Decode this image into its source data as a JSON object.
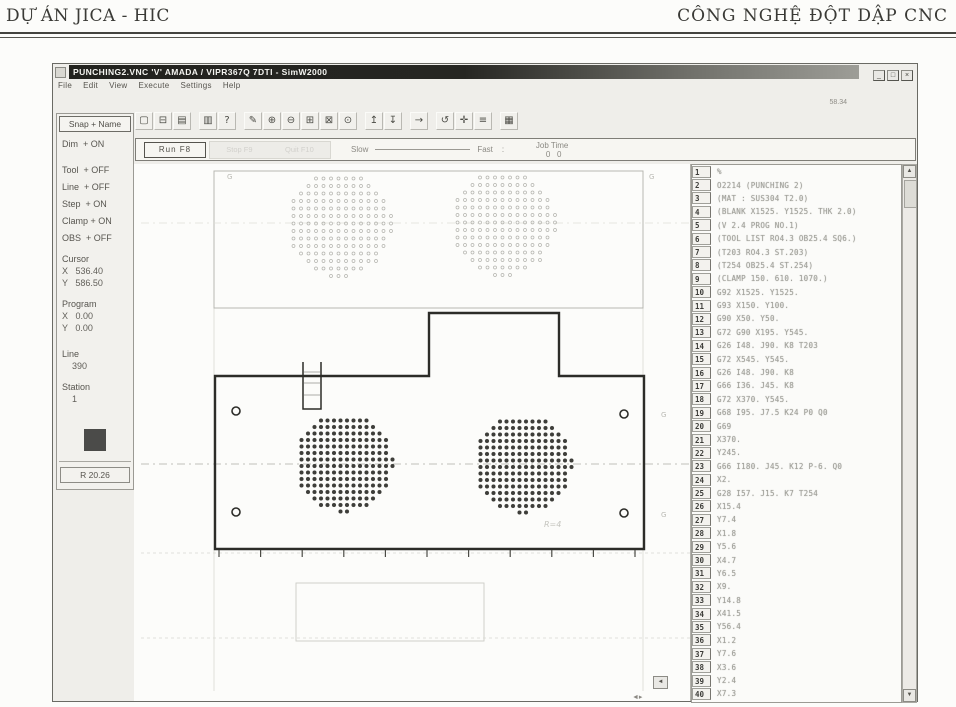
{
  "header": {
    "left": "DỰ ÁN JICA - HIC",
    "right": "CÔNG NGHỆ ĐỘT DẬP CNC"
  },
  "window": {
    "title": "PUNCHING2.VNC 'V' AMADA / VIPR367Q 7DTI - SimW2000",
    "controls": [
      {
        "name": "minimize-button",
        "glyph": "_"
      },
      {
        "name": "maximize-button",
        "glyph": "□"
      },
      {
        "name": "close-button",
        "glyph": "×"
      }
    ],
    "menu": [
      "File",
      "Edit",
      "View",
      "Execute",
      "Settings",
      "Help"
    ],
    "corner_note": "58.34"
  },
  "toolbar": {
    "groups": [
      [
        "new",
        "open",
        "save"
      ],
      [
        "print",
        "help"
      ],
      [
        "pointer",
        "zoom-in",
        "zoom-out",
        "zoom-window",
        "zoom-fit",
        "zoom-prev"
      ],
      [
        "step-up",
        "step-down"
      ],
      [
        "run-forward"
      ],
      [
        "rotate",
        "crosshair",
        "list"
      ],
      [
        "nc-editor"
      ]
    ],
    "glyphs": {
      "new": "▢",
      "open": "⊟",
      "save": "▤",
      "print": "▥",
      "help": "?",
      "pointer": "✎",
      "zoom-in": "⊕",
      "zoom-out": "⊖",
      "zoom-window": "⊞",
      "zoom-fit": "⊠",
      "zoom-prev": "⊙",
      "step-up": "↥",
      "step-down": "↧",
      "run-forward": "→",
      "rotate": "↺",
      "crosshair": "✛",
      "list": "≡",
      "nc-editor": "▦"
    }
  },
  "sidebar": {
    "snap_button": "Snap + Name",
    "items": [
      {
        "name": "toggle-dim",
        "text": "Dim  + ON",
        "cls": ""
      },
      {
        "name": "toggle-tool",
        "text": "Tool  + OFF",
        "cls": "glg"
      },
      {
        "name": "toggle-line",
        "text": "Line  + OFF",
        "cls": "gsm"
      },
      {
        "name": "toggle-step",
        "text": "Step  + ON",
        "cls": "gsm"
      },
      {
        "name": "toggle-clamp",
        "text": "Clamp + ON",
        "cls": "gsm"
      },
      {
        "name": "toggle-obs",
        "text": "OBS  + OFF",
        "cls": "gsm"
      },
      {
        "name": "cursor-label",
        "text": "Cursor",
        "cls": "gmd"
      },
      {
        "name": "cursor-x",
        "text": "X   536.40",
        "cls": "val"
      },
      {
        "name": "cursor-y",
        "text": "Y   586.50",
        "cls": "val"
      },
      {
        "name": "program-label",
        "text": "Program",
        "cls": "gmd"
      },
      {
        "name": "program-x",
        "text": "X   0.00",
        "cls": "val"
      },
      {
        "name": "program-y",
        "text": "Y   0.00",
        "cls": "val"
      },
      {
        "name": "line-label",
        "text": "Line",
        "cls": "glg"
      },
      {
        "name": "line-value",
        "text": "390",
        "cls": "val ind"
      },
      {
        "name": "station-label",
        "text": "Station",
        "cls": "gmd"
      },
      {
        "name": "station-value",
        "text": "1",
        "cls": "val ind"
      }
    ],
    "swatch_color": "#4b4b49",
    "bottom_button": "R 20.26"
  },
  "runbar": {
    "run_label": "Run F8",
    "ghost_labels": [
      "Stop F9",
      "Quit F10"
    ],
    "slow_label": "Slow",
    "fast_label": "Fast",
    "sep": ":",
    "job_label": "Job Time",
    "job_values": "0   0"
  },
  "nc_list": {
    "rows": [
      {
        "n": "1",
        "text": "%"
      },
      {
        "n": "2",
        "text": "O2214 (PUNCHING 2)"
      },
      {
        "n": "3",
        "text": "(MAT : SUS304 T2.0)"
      },
      {
        "n": "4",
        "text": "(BLANK X1525. Y1525. THK 2.0)"
      },
      {
        "n": "5",
        "text": "(V 2.4 PROG NO.1)"
      },
      {
        "n": "6",
        "text": "(TOOL LIST RO4.3 OB25.4 SQ6.)"
      },
      {
        "n": "7",
        "text": "(T203 RO4.3 ST.203)"
      },
      {
        "n": "8",
        "text": "(T254 OB25.4 ST.254)"
      },
      {
        "n": "9",
        "text": "(CLAMP 150. 610. 1070.)"
      },
      {
        "n": "10",
        "text": "G92 X1525. Y1525."
      },
      {
        "n": "11",
        "text": "G93 X150. Y100."
      },
      {
        "n": "12",
        "text": "G90 X50. Y50."
      },
      {
        "n": "13",
        "text": "G72 G90 X195. Y545."
      },
      {
        "n": "14",
        "text": "G26 I48. J90. K8 T203"
      },
      {
        "n": "15",
        "text": "G72 X545. Y545."
      },
      {
        "n": "16",
        "text": "G26 I48. J90. K8"
      },
      {
        "n": "17",
        "text": "G66 I36. J45. K8"
      },
      {
        "n": "18",
        "text": "G72 X370. Y545."
      },
      {
        "n": "19",
        "text": "G68 I95. J7.5 K24 P0 Q0"
      },
      {
        "n": "20",
        "text": "G69"
      },
      {
        "n": "21",
        "text": "X370."
      },
      {
        "n": "22",
        "text": "Y245."
      },
      {
        "n": "23",
        "text": "G66 I180. J45. K12 P-6. Q0"
      },
      {
        "n": "24",
        "text": "X2."
      },
      {
        "n": "25",
        "text": "G28 I57. J15. K7 T254"
      },
      {
        "n": "26",
        "text": "X15.4"
      },
      {
        "n": "27",
        "text": "Y7.4"
      },
      {
        "n": "28",
        "text": "X1.8"
      },
      {
        "n": "29",
        "text": "Y5.6"
      },
      {
        "n": "30",
        "text": "X4.7"
      },
      {
        "n": "31",
        "text": "Y6.5"
      },
      {
        "n": "32",
        "text": "X9."
      },
      {
        "n": "33",
        "text": "Y14.8"
      },
      {
        "n": "34",
        "text": "X41.5"
      },
      {
        "n": "35",
        "text": "Y56.4"
      },
      {
        "n": "36",
        "text": "X1.2"
      },
      {
        "n": "37",
        "text": "Y7.6"
      },
      {
        "n": "38",
        "text": "X3.6"
      },
      {
        "n": "39",
        "text": "Y2.4"
      },
      {
        "n": "40",
        "text": "X7.3"
      }
    ]
  },
  "drawing": {
    "sheet": {
      "x": 213,
      "y": 170,
      "w": 429,
      "h": 137
    },
    "sheet_centerline_y": 222,
    "ghost_clusters": [
      {
        "cx": 338,
        "cy": 223,
        "r": 53
      },
      {
        "cx": 502,
        "cy": 222,
        "r": 53
      }
    ],
    "ghost_spacing": 7.5,
    "ghost_dot_r": 1.5,
    "part_path": "M214,548 L214,375 L428,375 L428,312 L558,312 L558,375 L643,375 L643,548 Z",
    "slot_path": "M302,361 L302,408 L320,408 L320,361",
    "slot_dashes": [
      371,
      382,
      394
    ],
    "corner_holes": [
      {
        "cx": 235,
        "cy": 410
      },
      {
        "cx": 235,
        "cy": 511
      },
      {
        "cx": 623,
        "cy": 413
      },
      {
        "cx": 623,
        "cy": 512
      }
    ],
    "hole_r": 4,
    "clusters": [
      {
        "cx": 343,
        "cy": 462,
        "r": 49
      },
      {
        "cx": 522,
        "cy": 463,
        "r": 49
      }
    ],
    "dot_spacing": 6.5,
    "dot_r": 1.9,
    "centerline_y": 463,
    "base_line_y": 552,
    "ticks": {
      "from": 218,
      "to": 636,
      "step": 41.6,
      "y1": 549,
      "y2": 556
    },
    "ghost_rect": {
      "x": 295,
      "y": 582,
      "w": 188,
      "h": 58
    },
    "ghost_line_y": 637,
    "annotation": {
      "text": "R=4",
      "x": 543,
      "y": 526
    },
    "marks": [
      {
        "t": "G",
        "x": 226,
        "y": 178
      },
      {
        "t": "G",
        "x": 648,
        "y": 178
      },
      {
        "t": "G",
        "x": 660,
        "y": 416
      },
      {
        "t": "G",
        "x": 660,
        "y": 516
      }
    ]
  },
  "scroll": {
    "up": "▲",
    "down": "▼",
    "left": "◄",
    "right": "►",
    "corner": "◄▸"
  },
  "colors": {
    "part_line": "#2c2c28",
    "dot": "#3e3e3a",
    "faint": "#b7b7b1",
    "swatch": "#4b4b49"
  }
}
